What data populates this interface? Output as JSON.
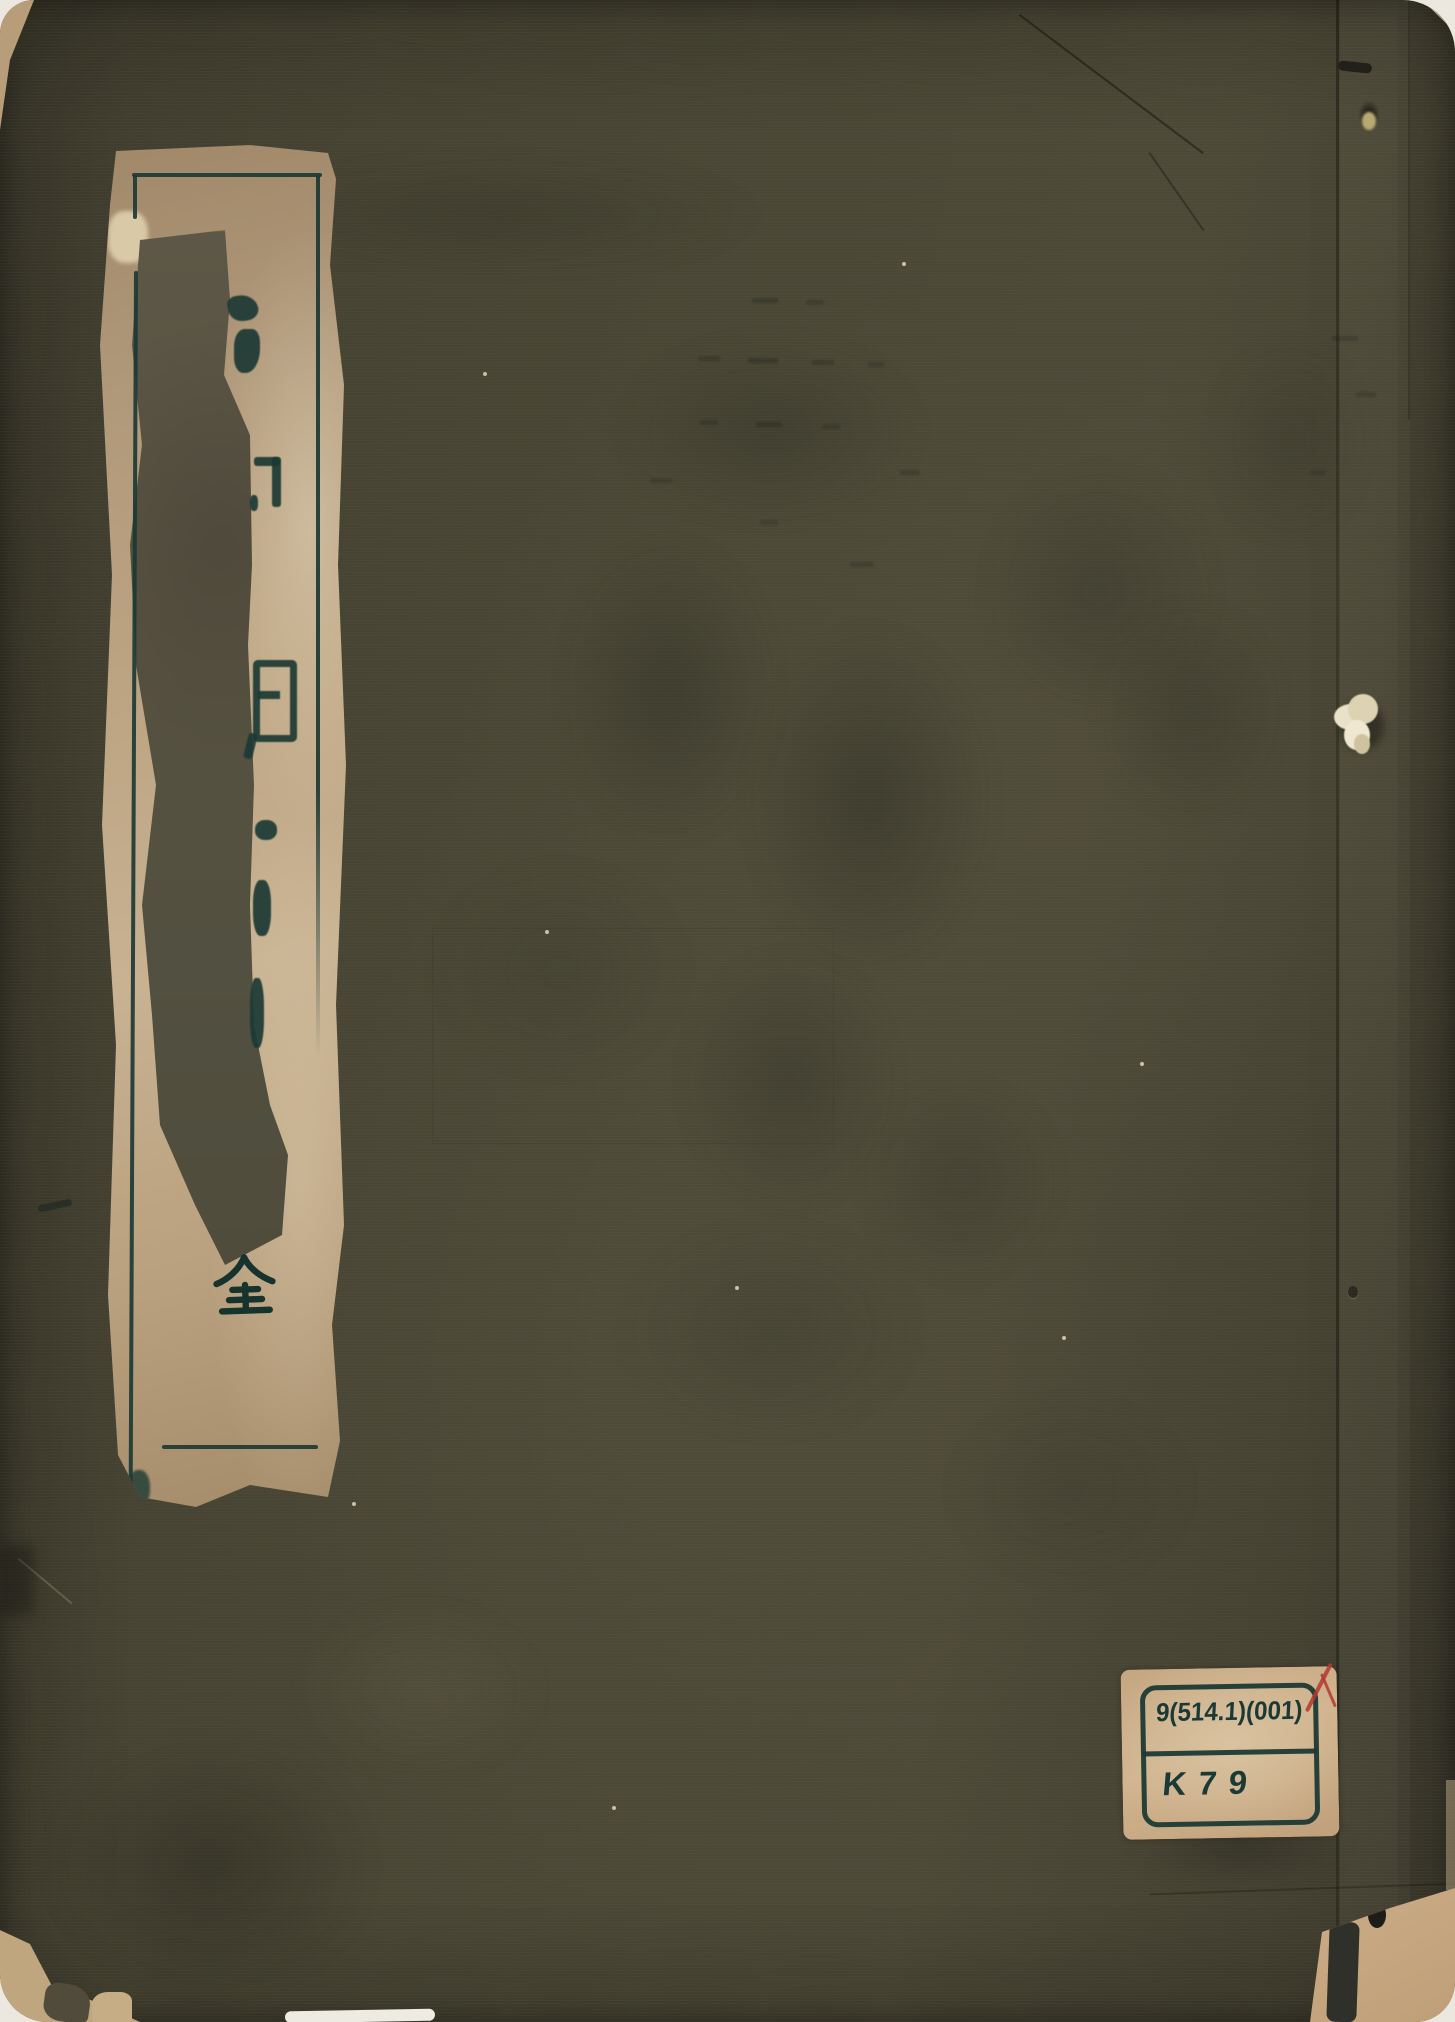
{
  "scan": {
    "title_label": {
      "visible_character": "全"
    },
    "call_number_label": {
      "line1": "9(514.1)(001)",
      "line2": "K79"
    },
    "colors": {
      "scan_background": "#ece8df",
      "cover_base": "#4a4636",
      "cover_shadow": "#36342a",
      "label_paper": "#bda583",
      "label_abraded": "#575242",
      "ink_teal": "#1c3a35",
      "call_label_paper": "#cfb38d",
      "red_mark": "#b23a31",
      "thread_cream": "#e9e1c8"
    }
  }
}
